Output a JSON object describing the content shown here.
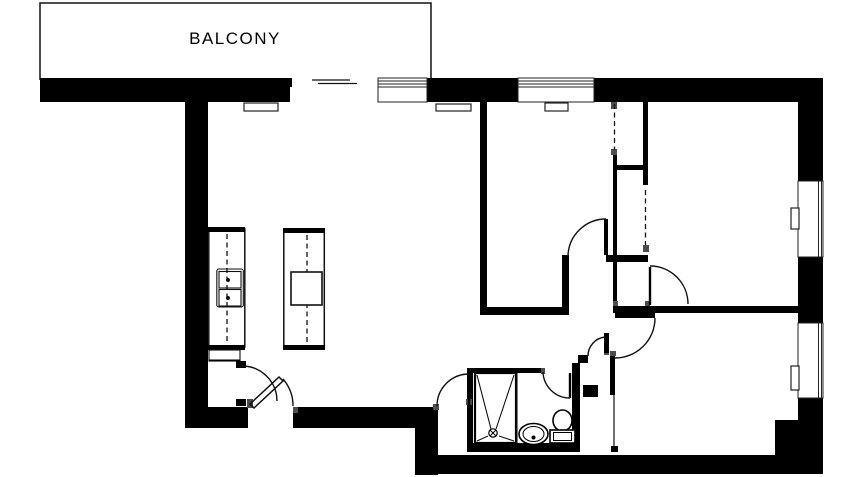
{
  "labels": {
    "balcony": "BALCONY"
  },
  "colors": {
    "wall": "#000000",
    "background": "#ffffff",
    "jamb": "#4d4d4d",
    "line": "#111111"
  },
  "plan": {
    "type": "apartment-floor-plan",
    "rooms_visible_text": [
      "BALCONY"
    ],
    "fixtures": [
      "stove-icon",
      "kitchen-counter",
      "kitchen-island",
      "island-sink-icon",
      "shower-icon",
      "shower-drain-icon",
      "washbasin-icon",
      "toilet-icon",
      "radiator",
      "window",
      "wardrobe-dashed-front",
      "door-swing-arc"
    ],
    "door_count": 8,
    "window_count": 4
  }
}
